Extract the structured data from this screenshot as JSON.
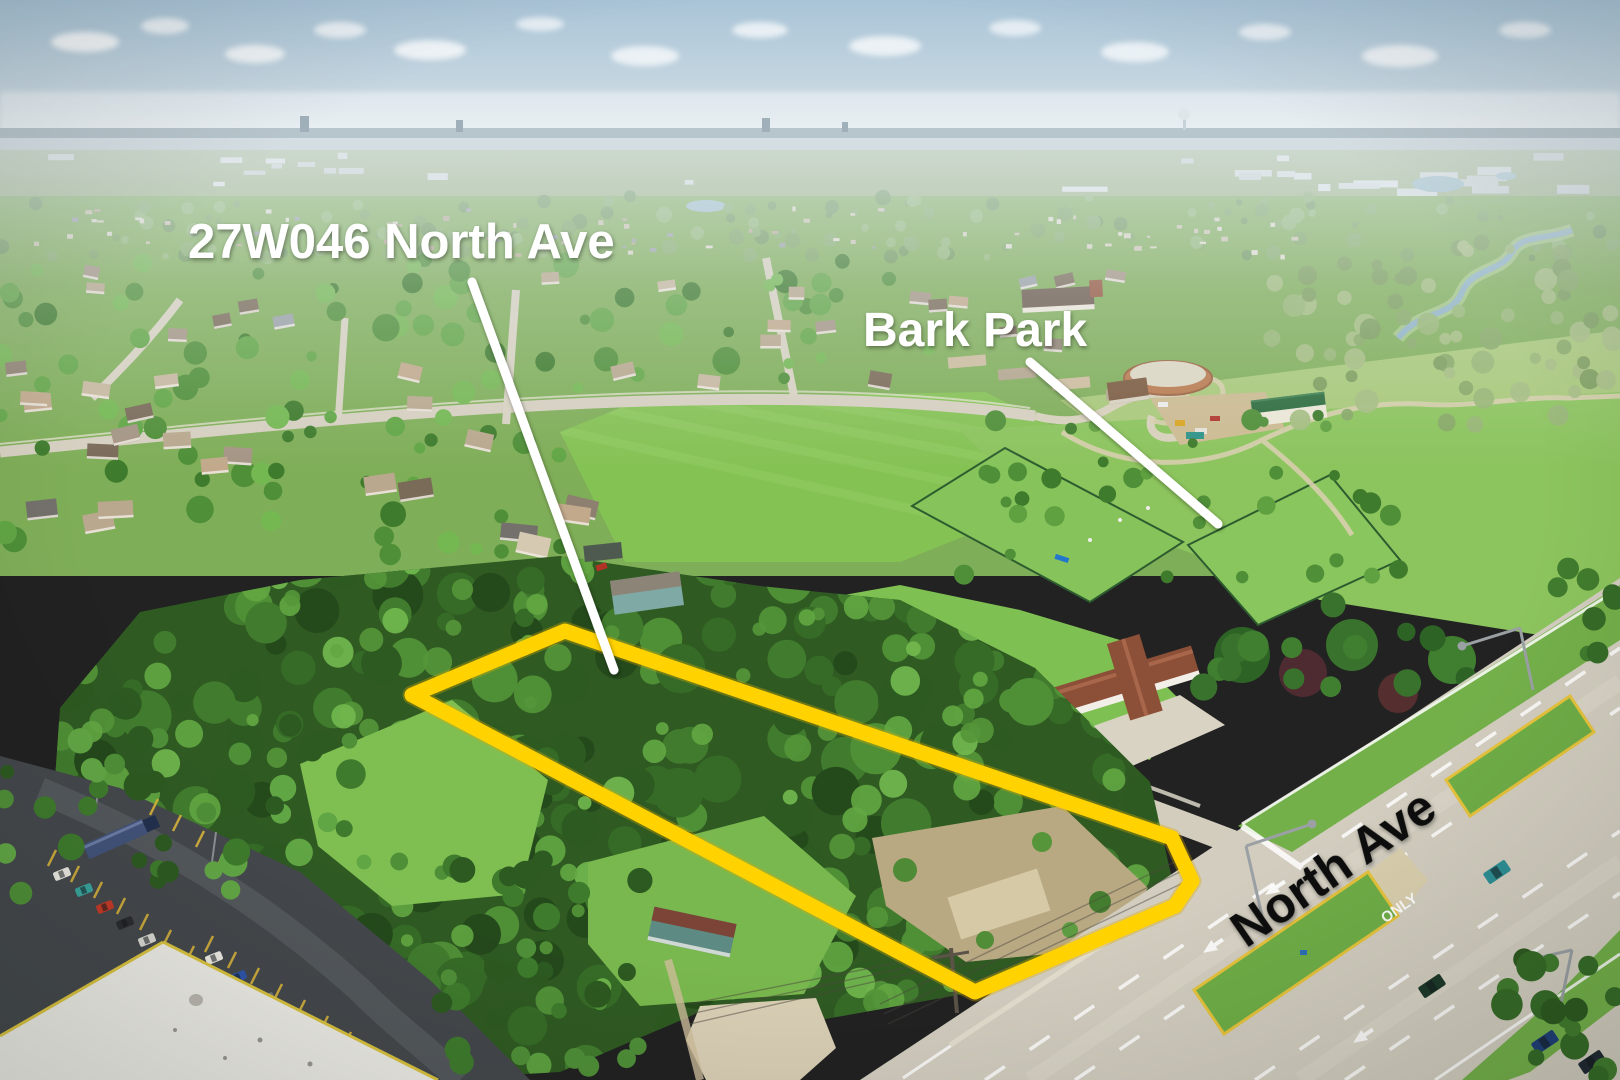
{
  "image": {
    "title": "Aerial drone photo of vacant wooded land for sale at the corner of North Ave",
    "type": "aerial-photo-with-annotations"
  },
  "annotations": {
    "property_label": "27W046 North Ave",
    "park_label": "Bark Park",
    "road_label": "North Ave",
    "pavement_marking": "ONLY"
  },
  "colors": {
    "boundary": "#FFD200",
    "boundary_shadow": "#D9A800",
    "callout_line": "#FFFFFF",
    "white_label": "#FFFFFF",
    "black_label": "#0B0B0B",
    "sky": "#AFC8D9",
    "field_green": "#85C254",
    "canopy_green": "#2F5A22",
    "highway_concrete": "#D2CDBF",
    "parking_asphalt": "#44484C"
  }
}
